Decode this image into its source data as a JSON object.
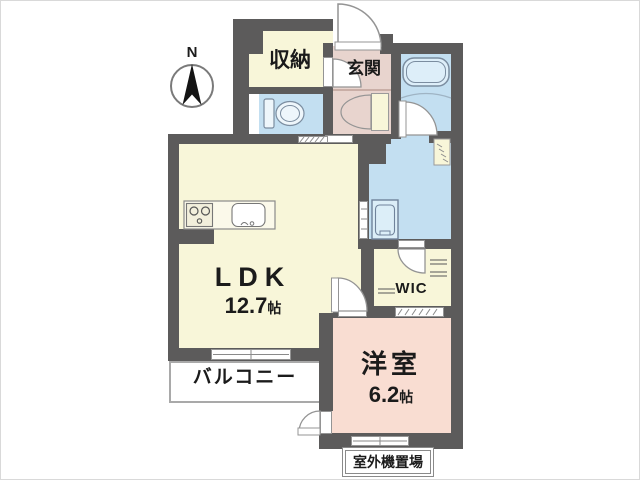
{
  "compass": {
    "label": "N"
  },
  "rooms": {
    "storage": {
      "label": "収納",
      "color": "#f8f6d9"
    },
    "entrance": {
      "label": "玄関",
      "color": "#e8d4ce"
    },
    "hallway": {
      "color": "#e8d4ce"
    },
    "toilet": {
      "color": "#c3dff1"
    },
    "bathroom": {
      "color": "#c3dff1"
    },
    "washroom": {
      "color": "#c3dff1"
    },
    "ldk": {
      "label": "LDK",
      "size_value": "12.7",
      "size_unit": "帖",
      "color": "#f8f6d9"
    },
    "wic": {
      "label": "WIC",
      "color": "#f8f6d9"
    },
    "western_room": {
      "label": "洋室",
      "size_value": "6.2",
      "size_unit": "帖",
      "color": "#f9ddd2"
    },
    "balcony": {
      "label": "バルコニー",
      "color": "#ffffff"
    },
    "outdoor_unit_space": {
      "label": "室外機置場",
      "color": "#ffffff"
    }
  },
  "colors": {
    "wall": "#5c5b5b",
    "fixture_outline": "#7b8da0",
    "door_outline": "#949494",
    "text": "#1b1b1b"
  },
  "fixtures": {
    "toilet": "toilet-icon",
    "bathtub": "bathtub-icon",
    "stove": "stove-icon",
    "sink": "sink-icon",
    "washing_machine": "washing-machine-icon",
    "compass": "north-compass-icon"
  }
}
